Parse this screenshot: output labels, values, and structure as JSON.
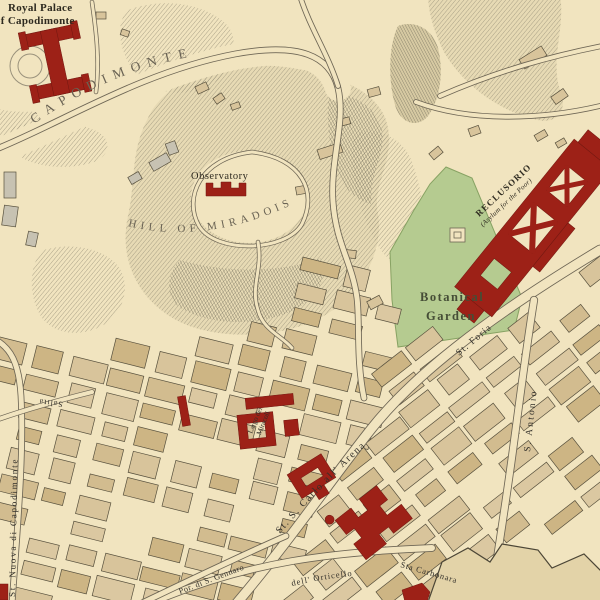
{
  "labels": {
    "royal_palace": {
      "line1": "Royal Palace",
      "line2": "of Capodimonte"
    },
    "capodimonte_hill": "CAPODIMONTE",
    "observatory": "Observatory",
    "hill_of_miradois": "HILL OF MIRADOIS",
    "reclusorio": {
      "line1": "RECLUSORIO",
      "line2": "(Asylum for the Poor)"
    },
    "botanical_garden": {
      "line1": "Botanical",
      "line2": "Garden"
    },
    "strada_foria": "St. Foria",
    "s_antonio": "S. Antonio",
    "s_carlo_all_arena": "St. S. Carlo all' Arena",
    "salita": "Salita",
    "strada_nuova_di_capodimonte": "St. Nuova di Capodimonte",
    "largo_dei_miracoli": {
      "line1": "Largo dei",
      "line2": "Miracoli"
    },
    "porta_s_gennaro": "Por. di S. Gennaro",
    "orticello": "dell' Orticello",
    "sta_carbonara": "Sta Carbonara"
  },
  "colors": {
    "paper": "#f1e4bf",
    "city_block": "#d8c49b",
    "block_outline": "#57503d",
    "landmark_red": "#9d2117",
    "garden_green": "#b5cb90",
    "garden_edge": "#87a263",
    "hill_hatch": "#968f78",
    "road_casing": "#6e6655",
    "label_ink": "#33302a",
    "hill_label_ink": "#6a6354",
    "garden_label_ink": "#454d36",
    "wall_fill": "#e3d3a8"
  }
}
